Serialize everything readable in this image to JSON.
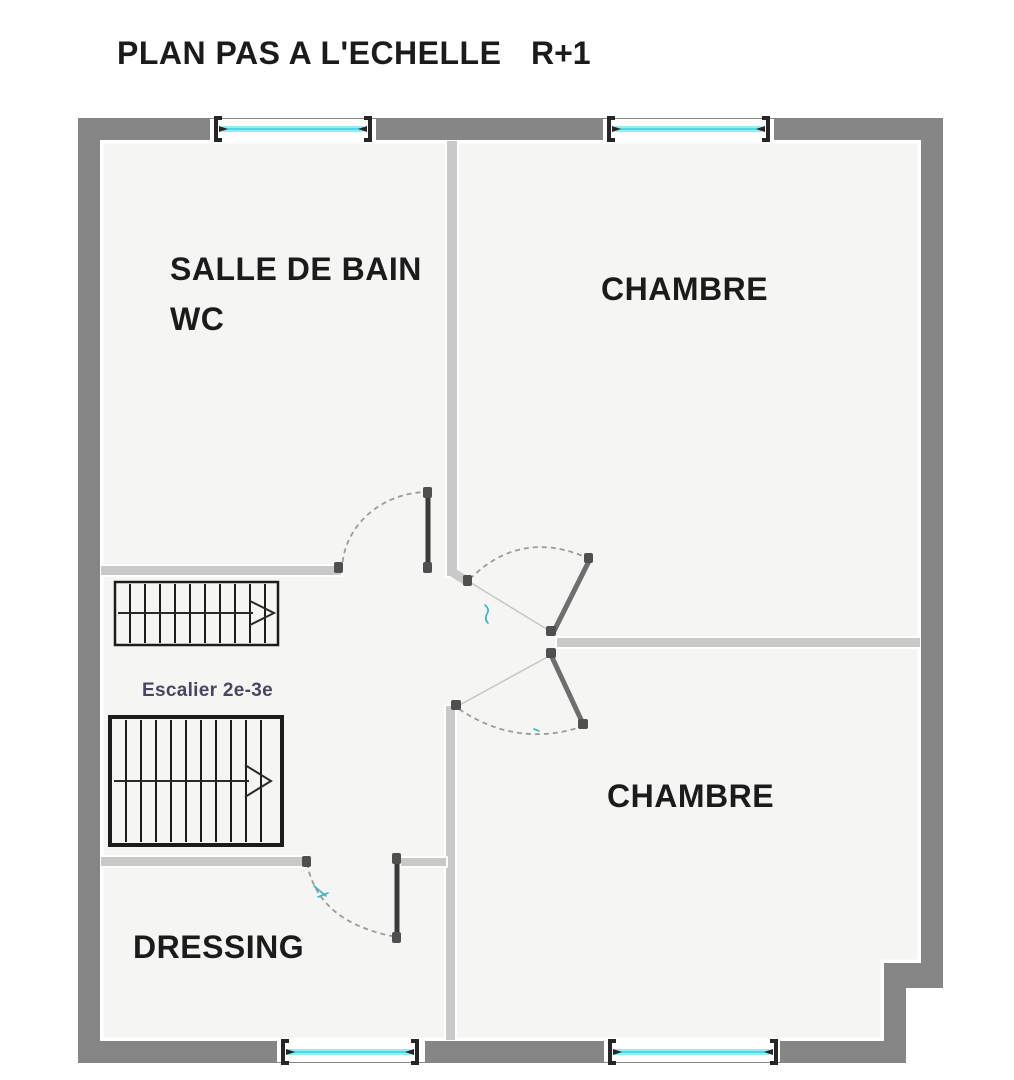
{
  "title": {
    "main": "PLAN PAS A L'ECHELLE",
    "level": "R+1"
  },
  "rooms": {
    "bathroom_line1": "SALLE DE BAIN",
    "bathroom_line2": "WC",
    "bedroom_top": "CHAMBRE",
    "bedroom_bottom": "CHAMBRE",
    "dressing": "DRESSING"
  },
  "stairs": {
    "label": "Escalier 2e-3e"
  },
  "colors": {
    "page_bg": "#ffffff",
    "text_primary": "#1b1b1b",
    "stair_label": "#4b4660",
    "wall_exterior": "#868686",
    "wall_interior": "#c9c9c9",
    "room_fill": "#f5f5f4",
    "window_glass": "#8feef2",
    "window_glass_core": "#4fd8e2",
    "door_dark": "#3a3a3a",
    "door_mid": "#6e6e6e",
    "arc_gray": "#9b9b9b",
    "hinge": "#4f4f4f",
    "stair_stroke": "#1c1c1c",
    "accent_teal": "#35b6c2"
  }
}
